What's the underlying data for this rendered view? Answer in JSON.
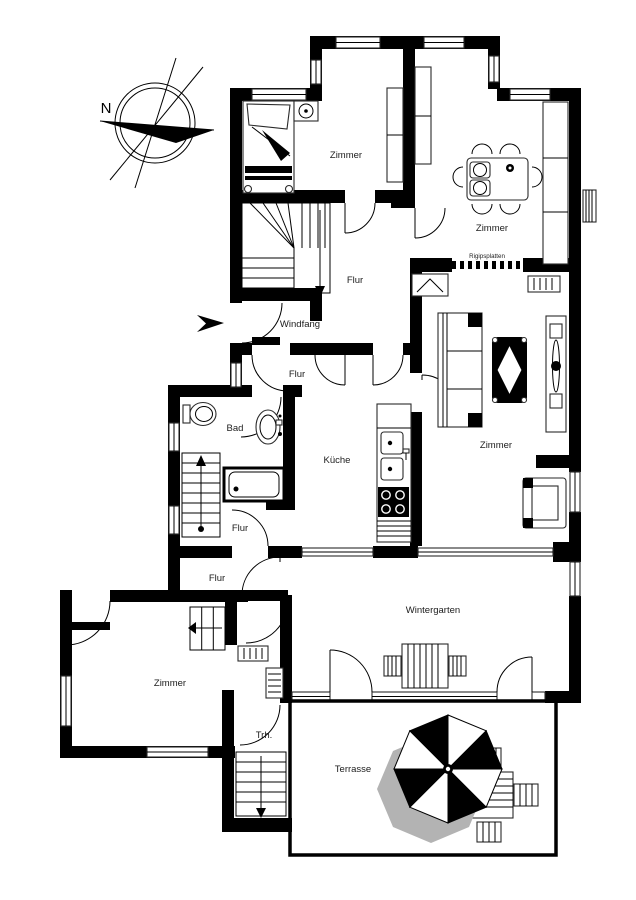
{
  "compass": {
    "north": "N"
  },
  "rooms": {
    "bedroom_top": "Zimmer",
    "dining_room": "Zimmer",
    "hall_upper": "Flur",
    "vestibule": "Windfang",
    "hall_inner": "Flur",
    "bathroom": "Bad",
    "kitchen": "Küche",
    "living_room": "Zimmer",
    "hall_middle": "Flur",
    "hall_lower": "Flur",
    "winter_garden": "Wintergarten",
    "bedroom_bottom": "Zimmer",
    "stairwell": "Trh.",
    "terrace": "Terrasse"
  },
  "notes": {
    "drywall": "Rigipsplatten"
  },
  "colors": {
    "wall": "#000000",
    "background": "#ffffff"
  }
}
